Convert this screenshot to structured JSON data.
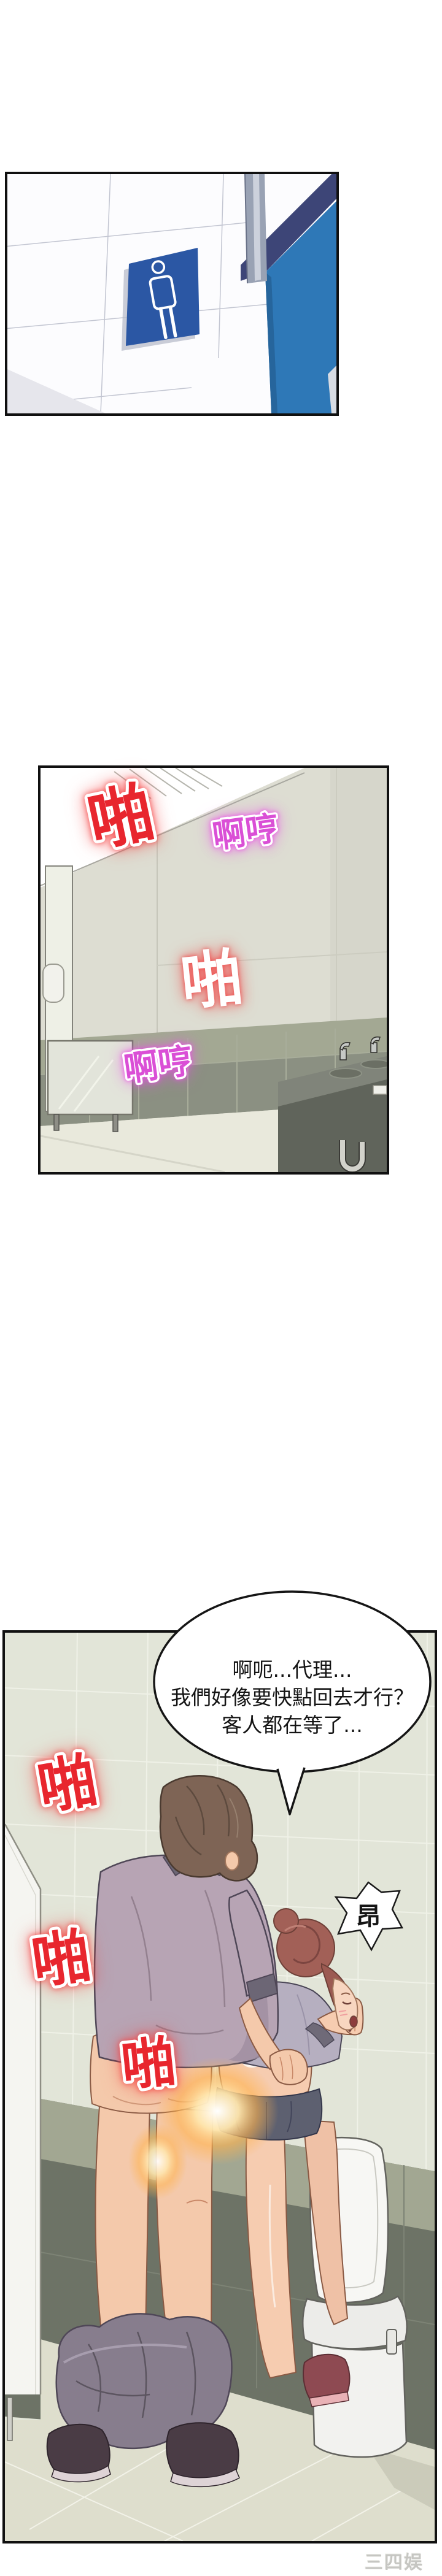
{
  "page": {
    "background": "#ffffff",
    "watermark": "三四娱乐"
  },
  "panel1": {
    "name": "restroom-entrance",
    "sign_icon": "male-restroom-icon",
    "sign_color": "#2b57a4",
    "door_color": "#2e78b7",
    "door_frame_color": "#3d4577"
  },
  "panel2": {
    "name": "bathroom-interior-wide",
    "sfx": [
      {
        "text": "啪",
        "style": "slap-red"
      },
      {
        "text": "啊哼",
        "style": "moan-magenta"
      },
      {
        "text": "啪",
        "style": "slap-white"
      },
      {
        "text": "啊哼",
        "style": "moan-magenta"
      }
    ]
  },
  "panel3": {
    "name": "couple-bathroom-scene",
    "bubble": {
      "lines": [
        "啊呃...代理...",
        "我們好像要快點回去才行？",
        "客人都在等了..."
      ]
    },
    "sfx": [
      {
        "text": "啪",
        "style": "slap-red"
      },
      {
        "text": "啪",
        "style": "slap-red"
      },
      {
        "text": "啪",
        "style": "slap-red"
      }
    ],
    "burst": {
      "text": "昂"
    }
  },
  "colors": {
    "sfx_red": "#e8262e",
    "sfx_magenta": "#da4fd6",
    "glow_censor": "#ffb34f",
    "wall_tile_light": "#e2e5d8",
    "wall_tile_dark": "#6d7366",
    "floor": "#dedecd"
  }
}
